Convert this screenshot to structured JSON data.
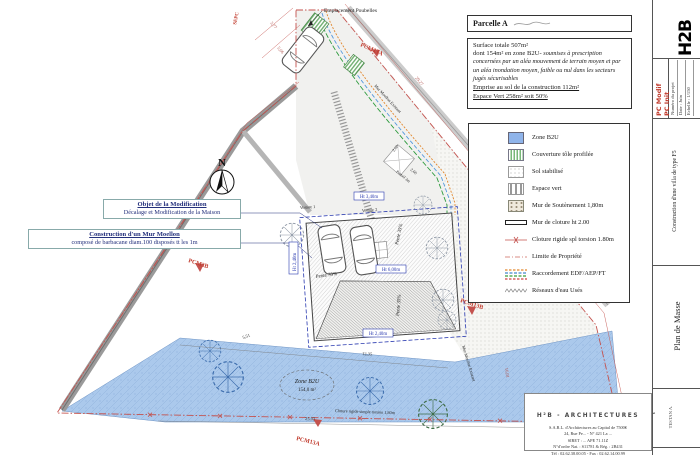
{
  "parcel_header": {
    "label": "Parcelle A"
  },
  "surface_box": {
    "line1": "Surface totale 507m²",
    "line2_normal": "dont 154m² en zone B2U-",
    "line2_italic": "soumises à prescription concernées par un aléa mouvement de terrain moyen et par un aléa inondation moyen, faible ou nul dans les secteurs jugés sécurisables",
    "line3": "Emprise au sol de la construction 112m²",
    "line4": "Espace Vert 258m² soit 50%"
  },
  "legend": {
    "items": [
      {
        "label": "Zone B2U"
      },
      {
        "label": "Couverture tôle profilée"
      },
      {
        "label": "Sol stabilisé"
      },
      {
        "label": "Espace vert"
      },
      {
        "label": "Mur de Soutènement 1,80m"
      },
      {
        "label": "Mur de cloture ht 2.00"
      },
      {
        "label": "Cloture rigide spl torsion 1.80m"
      },
      {
        "label": "Limite de Propriété"
      },
      {
        "label": "Raccordement EDF/AEP/FT"
      },
      {
        "label": "Réseaux d'eau Usés"
      }
    ]
  },
  "annotations": {
    "modification": {
      "title": "Objet de la Modification",
      "body": "Décalage et Modification de la Maison"
    },
    "mur": {
      "title": "Construction d'un Mur Moellon",
      "body": "composé de barbacane diam.100 disposés tt les 1m"
    }
  },
  "plan_labels": {
    "north": "N",
    "emplacement_poubelles": "Emplacement Poubelles",
    "zone_b2u_name": "Zone B2U",
    "zone_b2u_area": "154,0 m²",
    "voiture1": "Voiture 1",
    "voiture2": "Voiture 2",
    "pente": "Pente 35%",
    "cloture_bottom": "Cloture rigide simple torsion 1,80m",
    "mur_moellon_existant": "Mur Moellon Existant",
    "portail": "Portail 3m",
    "ht_340": "Ht 3,40m",
    "ht_600": "Ht 6,00m",
    "ht_240": "Ht 2,40m"
  },
  "ref_marks": {
    "top": "PCM13A",
    "left": "PCM3B",
    "right": "PCM13B",
    "bottom": "PCM13A",
    "sepc": "SEPC"
  },
  "dims": {
    "d1": "29,27",
    "d2": "24,66",
    "d3": "25,03",
    "d4": "12,35",
    "d5": "5,51",
    "d6": "2,00",
    "d7": "2,60",
    "d8": "16,01",
    "d9": "3,77",
    "d10": "5,06"
  },
  "titleblock": {
    "logo": "H2B",
    "logo_sub": "architectures",
    "pc_modif": "PC Modif",
    "pc_init": "PC Init",
    "numero_projet": "Numéro du projet",
    "date_label": "Date",
    "date_value": "Juin",
    "echelle_label": "Echelle",
    "echelle_value": "1/150",
    "projet": "Construction d'une villa de type F5",
    "doc_title": "Plan de Masse",
    "client": "TESTAN A."
  },
  "firm": {
    "name": "H²B - ARCHITECTURES",
    "line2": "S.A.R.L. d'Architectures au Capital de 7500€",
    "line3": "24, Rue Pe... - N° 421 La ...",
    "line4": "SIRET : ... APE 71.11Z",
    "line5": "N°d'ordre Nat. : S11781 & Rég. : 2B431",
    "line6": "Tél : 02.62.38.00.05 - Fax : 02.62.14.00.99"
  }
}
